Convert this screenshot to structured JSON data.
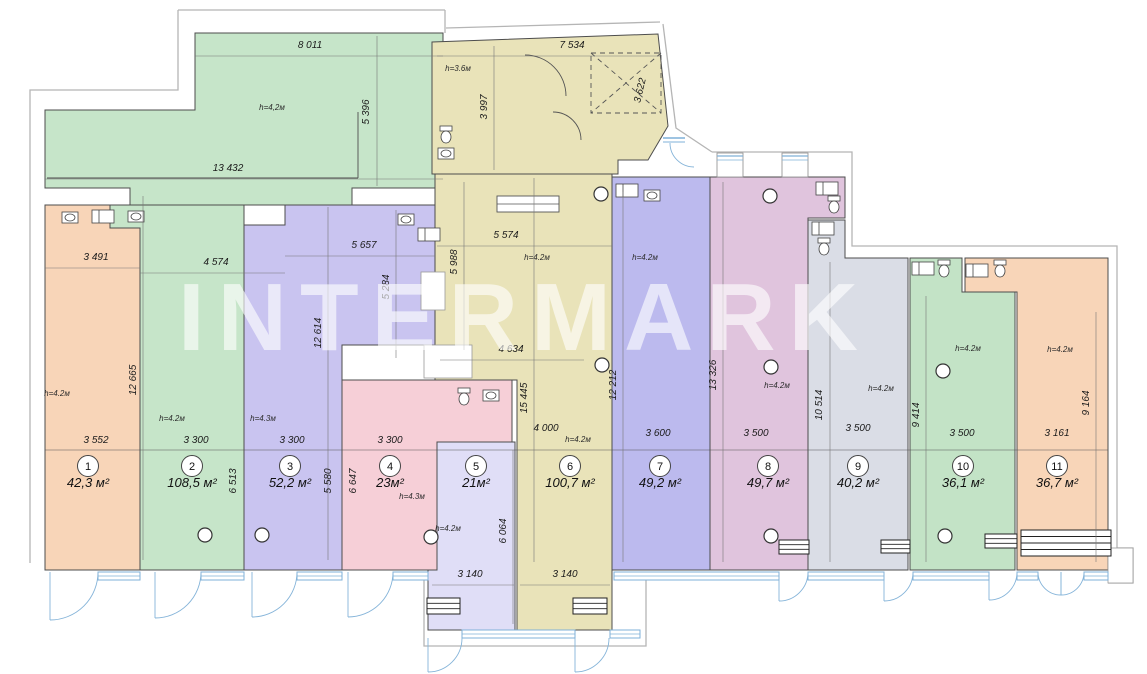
{
  "watermark": {
    "text": "INTERMARK"
  },
  "canvas": {
    "w": 1147,
    "h": 674,
    "bg": "#ffffff"
  },
  "colors": {
    "wall": "#4d4d4d",
    "shell": "#b5b5b5",
    "dimline": "#777777",
    "window_blue": "#7fb0d8",
    "door_blue": "#85b4d9",
    "fixture": "#444444"
  },
  "rooms": [
    {
      "number": "1",
      "area": "42,3 м²",
      "fill": "#f8d5b8",
      "badge": [
        88,
        466
      ],
      "polys": [
        "45,205 110,205 110,228 140,228 140,570 45,570"
      ]
    },
    {
      "number": "2",
      "area": "108,5 м²",
      "fill": "#c6e5c9",
      "badge": [
        192,
        466
      ],
      "polys": [
        "195,33 443,33 443,188 352,188 352,205 130,205 130,188 45,188 45,110 195,110",
        "110,205 244,205 244,570 140,570 140,228 110,228"
      ]
    },
    {
      "number": "3",
      "area": "52,2 м²",
      "fill": "#c9c4f0",
      "badge": [
        290,
        466
      ],
      "polys": [
        "285,205 435,205 435,345 342,345 342,570 244,570 244,225 285,225"
      ]
    },
    {
      "number": "4",
      "area": "23м²",
      "fill": "#f6cfd7",
      "badge": [
        390,
        466
      ],
      "polys": [
        "342,380 512,380 512,442 437,442 437,570 342,570"
      ]
    },
    {
      "number": "5",
      "area": "21м²",
      "fill": "#e0def7",
      "badge": [
        476,
        466
      ],
      "polys": [
        "437,442 515,442 515,630 428,630 428,570 437,570"
      ]
    },
    {
      "number": "6",
      "area": "100,7 м²",
      "fill": "#e9e3b9",
      "badge": [
        570,
        466
      ],
      "polys": [
        "432,42 658,34 668,126 648,160 618,160 618,174 432,174",
        "435,174 612,174 612,630 517,630 517,380 435,380"
      ]
    },
    {
      "number": "7",
      "area": "49,2 м²",
      "fill": "#bcbaee",
      "badge": [
        660,
        466
      ],
      "polys": [
        "612,177 710,177 710,570 612,570"
      ]
    },
    {
      "number": "8",
      "area": "49,7 м²",
      "fill": "#e0c4dd",
      "badge": [
        768,
        466
      ],
      "polys": [
        "710,177 845,177 845,218 808,218 808,570 710,570"
      ]
    },
    {
      "number": "9",
      "area": "40,2 м²",
      "fill": "#dadde6",
      "badge": [
        858,
        466
      ],
      "polys": [
        "808,220 845,220 845,258 908,258 908,570 808,570"
      ]
    },
    {
      "number": "10",
      "area": "36,1 м²",
      "fill": "#c3e3c6",
      "badge": [
        963,
        466
      ],
      "polys": [
        "910,258 962,258 962,292 1015,292 1015,570 910,570"
      ]
    },
    {
      "number": "11",
      "area": "36,7 м²",
      "fill": "#f8d5b8",
      "badge": [
        1057,
        466
      ],
      "polys": [
        "965,258 1108,258 1108,570 1017,570 1017,292 965,292"
      ]
    }
  ],
  "dimensions": [
    {
      "t": "8 011",
      "x": 310,
      "y": 48,
      "r": 0,
      "l": [
        195,
        56,
        443,
        56
      ]
    },
    {
      "t": "13 432",
      "x": 228,
      "y": 171,
      "r": 0,
      "l": [
        45,
        179,
        443,
        179
      ]
    },
    {
      "t": "5 396",
      "x": 369,
      "y": 112,
      "r": -90,
      "l": [
        377,
        36,
        377,
        186
      ]
    },
    {
      "t": "7 534",
      "x": 572,
      "y": 48,
      "r": 0,
      "l": [
        437,
        56,
        660,
        56
      ]
    },
    {
      "t": "3 997",
      "x": 487,
      "y": 107,
      "r": -90,
      "l": [
        494,
        46,
        494,
        170
      ]
    },
    {
      "t": "3 622",
      "x": 643,
      "y": 91,
      "r": -77
    },
    {
      "t": "3 491",
      "x": 96,
      "y": 260,
      "r": 0,
      "l": [
        45,
        268,
        140,
        268
      ]
    },
    {
      "t": "4 574",
      "x": 216,
      "y": 265,
      "r": 0,
      "l": [
        140,
        273,
        285,
        273
      ]
    },
    {
      "t": "5 657",
      "x": 364,
      "y": 248,
      "r": 0,
      "l": [
        285,
        256,
        435,
        256
      ]
    },
    {
      "t": "5 574",
      "x": 506,
      "y": 238,
      "r": 0,
      "l": [
        437,
        246,
        612,
        246
      ]
    },
    {
      "t": "12 665",
      "x": 136,
      "y": 380,
      "r": -90,
      "l": [
        143,
        196,
        143,
        560
      ]
    },
    {
      "t": "12 614",
      "x": 321,
      "y": 333,
      "r": -90,
      "l": [
        328,
        207,
        328,
        560
      ]
    },
    {
      "t": "5 284",
      "x": 389,
      "y": 287,
      "r": -90,
      "l": [
        396,
        210,
        396,
        358
      ]
    },
    {
      "t": "5 988",
      "x": 457,
      "y": 262,
      "r": -90,
      "l": [
        464,
        182,
        464,
        350
      ]
    },
    {
      "t": "4 634",
      "x": 511,
      "y": 352,
      "r": 0,
      "l": [
        440,
        360,
        584,
        360
      ]
    },
    {
      "t": "15 445",
      "x": 527,
      "y": 398,
      "r": -90,
      "l": [
        534,
        178,
        534,
        562
      ]
    },
    {
      "t": "12 212",
      "x": 616,
      "y": 385,
      "r": -90,
      "l": [
        623,
        192,
        623,
        562
      ]
    },
    {
      "t": "13 326",
      "x": 716,
      "y": 375,
      "r": -90,
      "l": [
        723,
        182,
        723,
        562
      ]
    },
    {
      "t": "10 514",
      "x": 822,
      "y": 405,
      "r": -90,
      "l": [
        830,
        262,
        830,
        562
      ]
    },
    {
      "t": "9 414",
      "x": 919,
      "y": 415,
      "r": -90,
      "l": [
        926,
        296,
        926,
        562
      ]
    },
    {
      "t": "9 164",
      "x": 1089,
      "y": 403,
      "r": -90,
      "l": [
        1096,
        312,
        1096,
        562
      ]
    },
    {
      "t": "3 552",
      "x": 96,
      "y": 443,
      "r": 0
    },
    {
      "t": "3 300",
      "x": 196,
      "y": 443,
      "r": 0
    },
    {
      "t": "3 300",
      "x": 292,
      "y": 443,
      "r": 0
    },
    {
      "t": "3 300",
      "x": 390,
      "y": 443,
      "r": 0
    },
    {
      "t": "4 000",
      "x": 546,
      "y": 431,
      "r": 0
    },
    {
      "t": "3 600",
      "x": 658,
      "y": 436,
      "r": 0
    },
    {
      "t": "3 500",
      "x": 756,
      "y": 436,
      "r": 0
    },
    {
      "t": "3 500",
      "x": 858,
      "y": 431,
      "r": 0
    },
    {
      "t": "3 500",
      "x": 962,
      "y": 436,
      "r": 0
    },
    {
      "t": "3 161",
      "x": 1057,
      "y": 436,
      "r": 0
    },
    {
      "t": "6 513",
      "x": 236,
      "y": 481,
      "r": -90
    },
    {
      "t": "5 580",
      "x": 331,
      "y": 481,
      "r": -90
    },
    {
      "t": "6 647",
      "x": 356,
      "y": 481,
      "r": -90
    },
    {
      "t": "6 064",
      "x": 506,
      "y": 531,
      "r": -90,
      "l": [
        513,
        450,
        513,
        624
      ]
    },
    {
      "t": "3 140",
      "x": 470,
      "y": 577,
      "r": 0,
      "l": [
        432,
        585,
        514,
        585
      ]
    },
    {
      "t": "3 140",
      "x": 565,
      "y": 577,
      "r": 0,
      "l": [
        520,
        585,
        610,
        585
      ]
    }
  ],
  "main_dim_line": [
    45,
    450,
    1108,
    450
  ],
  "height_notes": [
    {
      "t": "h=4,2м",
      "x": 272,
      "y": 110
    },
    {
      "t": "h=3.6м",
      "x": 458,
      "y": 71
    },
    {
      "t": "h=4.2м",
      "x": 57,
      "y": 396
    },
    {
      "t": "h=4.2м",
      "x": 172,
      "y": 421
    },
    {
      "t": "h=4.3м",
      "x": 263,
      "y": 421
    },
    {
      "t": "h=4.3м",
      "x": 412,
      "y": 499
    },
    {
      "t": "h=4.2м",
      "x": 448,
      "y": 531
    },
    {
      "t": "h=4.2м",
      "x": 537,
      "y": 260
    },
    {
      "t": "h=4.2м",
      "x": 578,
      "y": 442
    },
    {
      "t": "h=4.2м",
      "x": 645,
      "y": 260
    },
    {
      "t": "h=4.2м",
      "x": 777,
      "y": 388
    },
    {
      "t": "h=4.2м",
      "x": 881,
      "y": 391
    },
    {
      "t": "h=4.2м",
      "x": 968,
      "y": 351
    },
    {
      "t": "h=4.2м",
      "x": 1060,
      "y": 352
    }
  ],
  "shell_paths": [
    "M178,10 H445",
    "M178,10 V90 H30 V563",
    "M445,10 V33",
    "M446,28 L660,22",
    "M663,24 L676,128 L712,152",
    "M712,152 H852 V246 H1117 V558",
    "M1117,548 H1133 V583 H1108",
    "M424,575 V646 H646 V575"
  ],
  "inner_walls": [
    "M47,178 H358",
    "M358,112 V178"
  ],
  "white_overlays": [
    [
      424,
      345,
      48,
      33
    ],
    [
      421,
      272,
      24,
      38
    ],
    [
      1108,
      548,
      25,
      35
    ]
  ],
  "windows_bottom": [
    [
      98,
      572,
      42
    ],
    [
      201,
      572,
      43
    ],
    [
      297,
      572,
      45
    ],
    [
      393,
      572,
      35
    ],
    [
      614,
      572,
      165
    ],
    [
      808,
      572,
      76
    ],
    [
      913,
      572,
      76
    ],
    [
      1017,
      572,
      21
    ],
    [
      1084,
      572,
      24
    ],
    [
      462,
      630,
      113
    ],
    [
      610,
      630,
      30
    ]
  ],
  "windows_top": [
    [
      717,
      153,
      26,
      24
    ],
    [
      782,
      153,
      26,
      24
    ]
  ],
  "window_small": [
    [
      663,
      138,
      22
    ]
  ],
  "doors_bottom": [
    {
      "x": 50,
      "w": 48,
      "y": 572
    },
    {
      "x": 155,
      "w": 46,
      "y": 572
    },
    {
      "x": 252,
      "w": 45,
      "y": 572
    },
    {
      "x": 348,
      "w": 45,
      "y": 572
    },
    {
      "x": 779,
      "w": 29,
      "y": 572
    },
    {
      "x": 884,
      "w": 29,
      "y": 572
    },
    {
      "x": 989,
      "w": 28,
      "y": 572
    },
    {
      "x": 1038,
      "w": 23,
      "y": 572,
      "m": 1
    },
    {
      "x": 1061,
      "w": 23,
      "y": 572
    },
    {
      "x": 428,
      "w": 34,
      "y": 638
    },
    {
      "x": 575,
      "w": 34,
      "y": 638
    }
  ],
  "interior_arcs": [
    "M525,55 A41,41 0 0 1 566,96",
    "M553,112 A28,28 0 0 1 581,140"
  ],
  "blue_arcs": [
    "M670,143 A24,24 0 0 0 694,167"
  ],
  "dashed_box": [
    591,
    53,
    70,
    60
  ],
  "entry_mat": [
    497,
    196,
    62,
    16
  ],
  "columns": [
    [
      601,
      194
    ],
    [
      770,
      196
    ],
    [
      602,
      365
    ],
    [
      771,
      367
    ],
    [
      943,
      371
    ],
    [
      205,
      535
    ],
    [
      262,
      535
    ],
    [
      431,
      537
    ],
    [
      771,
      536
    ],
    [
      945,
      536
    ]
  ],
  "fixtures": [
    {
      "x": 62,
      "y": 212,
      "type": "sink"
    },
    {
      "x": 92,
      "y": 210,
      "type": "counter"
    },
    {
      "x": 128,
      "y": 211,
      "type": "sink"
    },
    {
      "x": 398,
      "y": 214,
      "type": "sink"
    },
    {
      "x": 418,
      "y": 228,
      "type": "counter"
    },
    {
      "x": 440,
      "y": 126,
      "type": "toilet"
    },
    {
      "x": 438,
      "y": 148,
      "type": "sink"
    },
    {
      "x": 458,
      "y": 388,
      "type": "toilet"
    },
    {
      "x": 483,
      "y": 390,
      "type": "sink"
    },
    {
      "x": 616,
      "y": 184,
      "type": "counter"
    },
    {
      "x": 644,
      "y": 190,
      "type": "sink"
    },
    {
      "x": 816,
      "y": 182,
      "type": "counter"
    },
    {
      "x": 828,
      "y": 196,
      "type": "toilet"
    },
    {
      "x": 812,
      "y": 222,
      "type": "counter"
    },
    {
      "x": 818,
      "y": 238,
      "type": "toilet"
    },
    {
      "x": 912,
      "y": 262,
      "type": "counter"
    },
    {
      "x": 938,
      "y": 260,
      "type": "toilet"
    },
    {
      "x": 966,
      "y": 264,
      "type": "counter"
    },
    {
      "x": 994,
      "y": 260,
      "type": "toilet"
    }
  ],
  "radiators": [
    {
      "x": 779,
      "y": 540,
      "w": 30,
      "h": 14,
      "lines": 2
    },
    {
      "x": 881,
      "y": 540,
      "w": 29,
      "h": 13,
      "lines": 2
    },
    {
      "x": 985,
      "y": 534,
      "w": 32,
      "h": 14,
      "lines": 2
    },
    {
      "x": 1021,
      "y": 530,
      "w": 90,
      "h": 26,
      "lines": 3
    },
    {
      "x": 427,
      "y": 598,
      "w": 33,
      "h": 16,
      "lines": 2
    },
    {
      "x": 573,
      "y": 598,
      "w": 34,
      "h": 16,
      "lines": 2
    }
  ]
}
